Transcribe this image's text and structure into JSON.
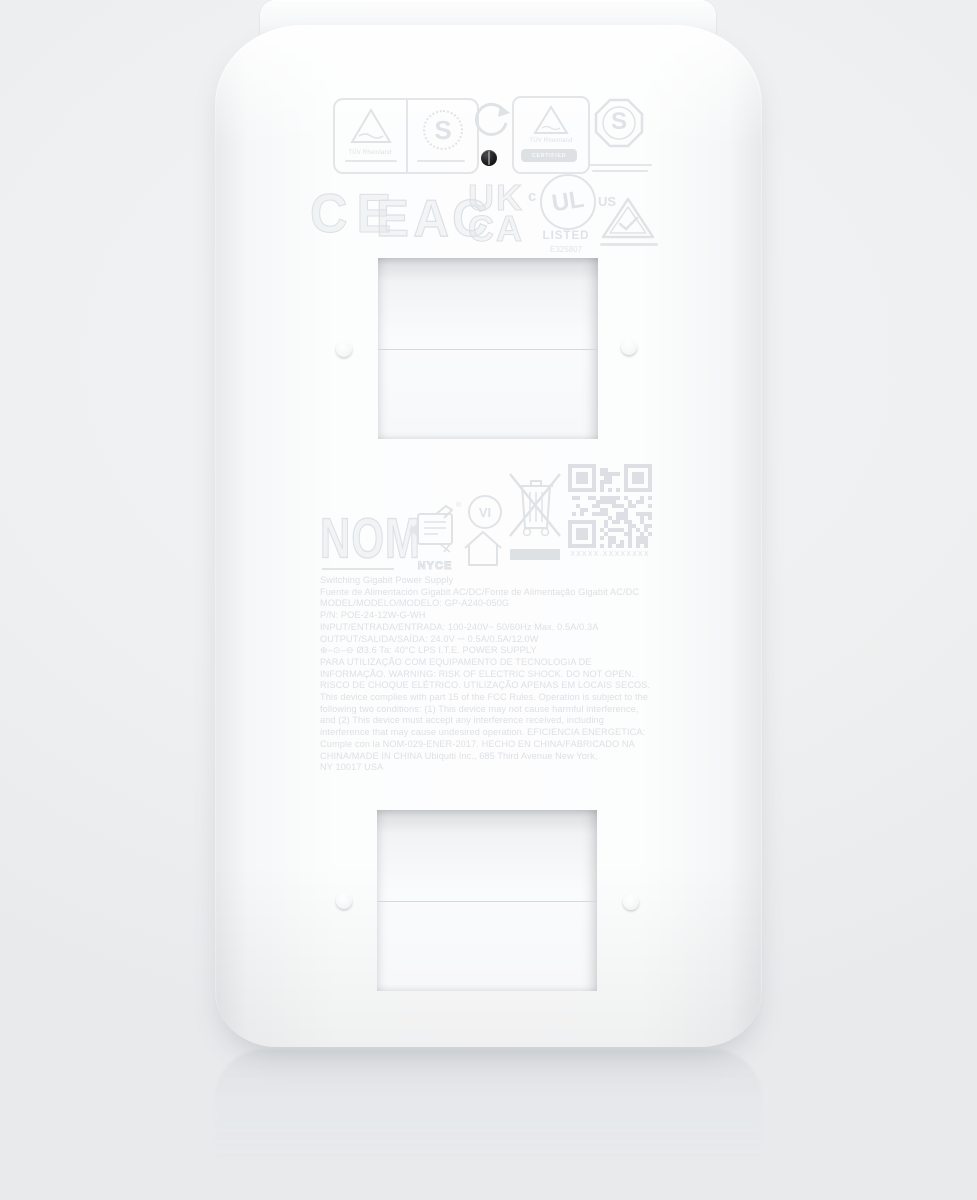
{
  "badges": {
    "tuv1": {
      "brand": "TÜV Rheinland",
      "s_mark": "S"
    },
    "tuv2": {
      "brand": "TÜV Rheinland",
      "band": "CERTIFIED"
    },
    "s_octagon": {
      "s_mark": "S"
    },
    "ce": "CE",
    "eac": "ЕАС",
    "ukca": {
      "line1": "UK",
      "line2": "CA"
    },
    "ul": {
      "letters": "UL",
      "c": "c",
      "us": "US",
      "listed": "LISTED",
      "file": "E325807"
    },
    "nom": "NOM",
    "nyce": {
      "name": "NYCE",
      "reg": "®"
    },
    "efficiency_vi": "VI",
    "qr_caption": "XXXXX.XXXXXXXX"
  },
  "label": {
    "lines": [
      "Switching Gigabit Power Supply",
      "Fuente de Alimentación Gigabit AC/DC/Fonte de Alimentação Gigabit AC/DC",
      "MODEL/MODELO/MODELO: GP-A240-050G",
      "P/N: POE-24-12W-G-WH",
      "INPUT/ENTRADA/ENTRADA: 100-240V~ 50/60Hz  Max. 0.5A/0.3A",
      "OUTPUT/SALIDA/SAÍDA: 24.0V ⎓ 0.5A/0.5A/12.0W",
      "⊕–⊙–⊖   Ø3.6   Ta: 40°C   LPS   I.T.E. POWER SUPPLY",
      "PARA UTILIZAÇÃO COM EQUIPAMENTO DE TECNOLOGIA DE",
      "INFORMAÇÃO.   WARNING:   RISK OF ELECTRIC SHOCK.   DO NOT OPEN.",
      "RISCO DE CHOQUE ELÉTRICO.   UTILIZAÇÃO APENAS EM LOCAIS SECOS.",
      "This device complies with part 15 of the FCC Rules. Operation is subject to the",
      "following two conditions: (1) This device may not cause harmful interference,",
      "and (2) This device must accept any interference received, including",
      "interference that may cause undesired operation. EFICIENCIA ENERGETICA:",
      "Cumple con la NOM-029-ENER-2017.   HECHO EN CHINA/FABRICADO NA",
      "CHINA/MADE IN CHINA    Ubiquiti Inc., 685 Third Avenue New York,",
      "NY 10017 USA"
    ]
  },
  "colors": {
    "background": "#eef0f1",
    "body": "#fcfdfd",
    "engraving": "#dfe2e6",
    "qr": "#dcdfe3",
    "screw": "#1d1d1f"
  }
}
